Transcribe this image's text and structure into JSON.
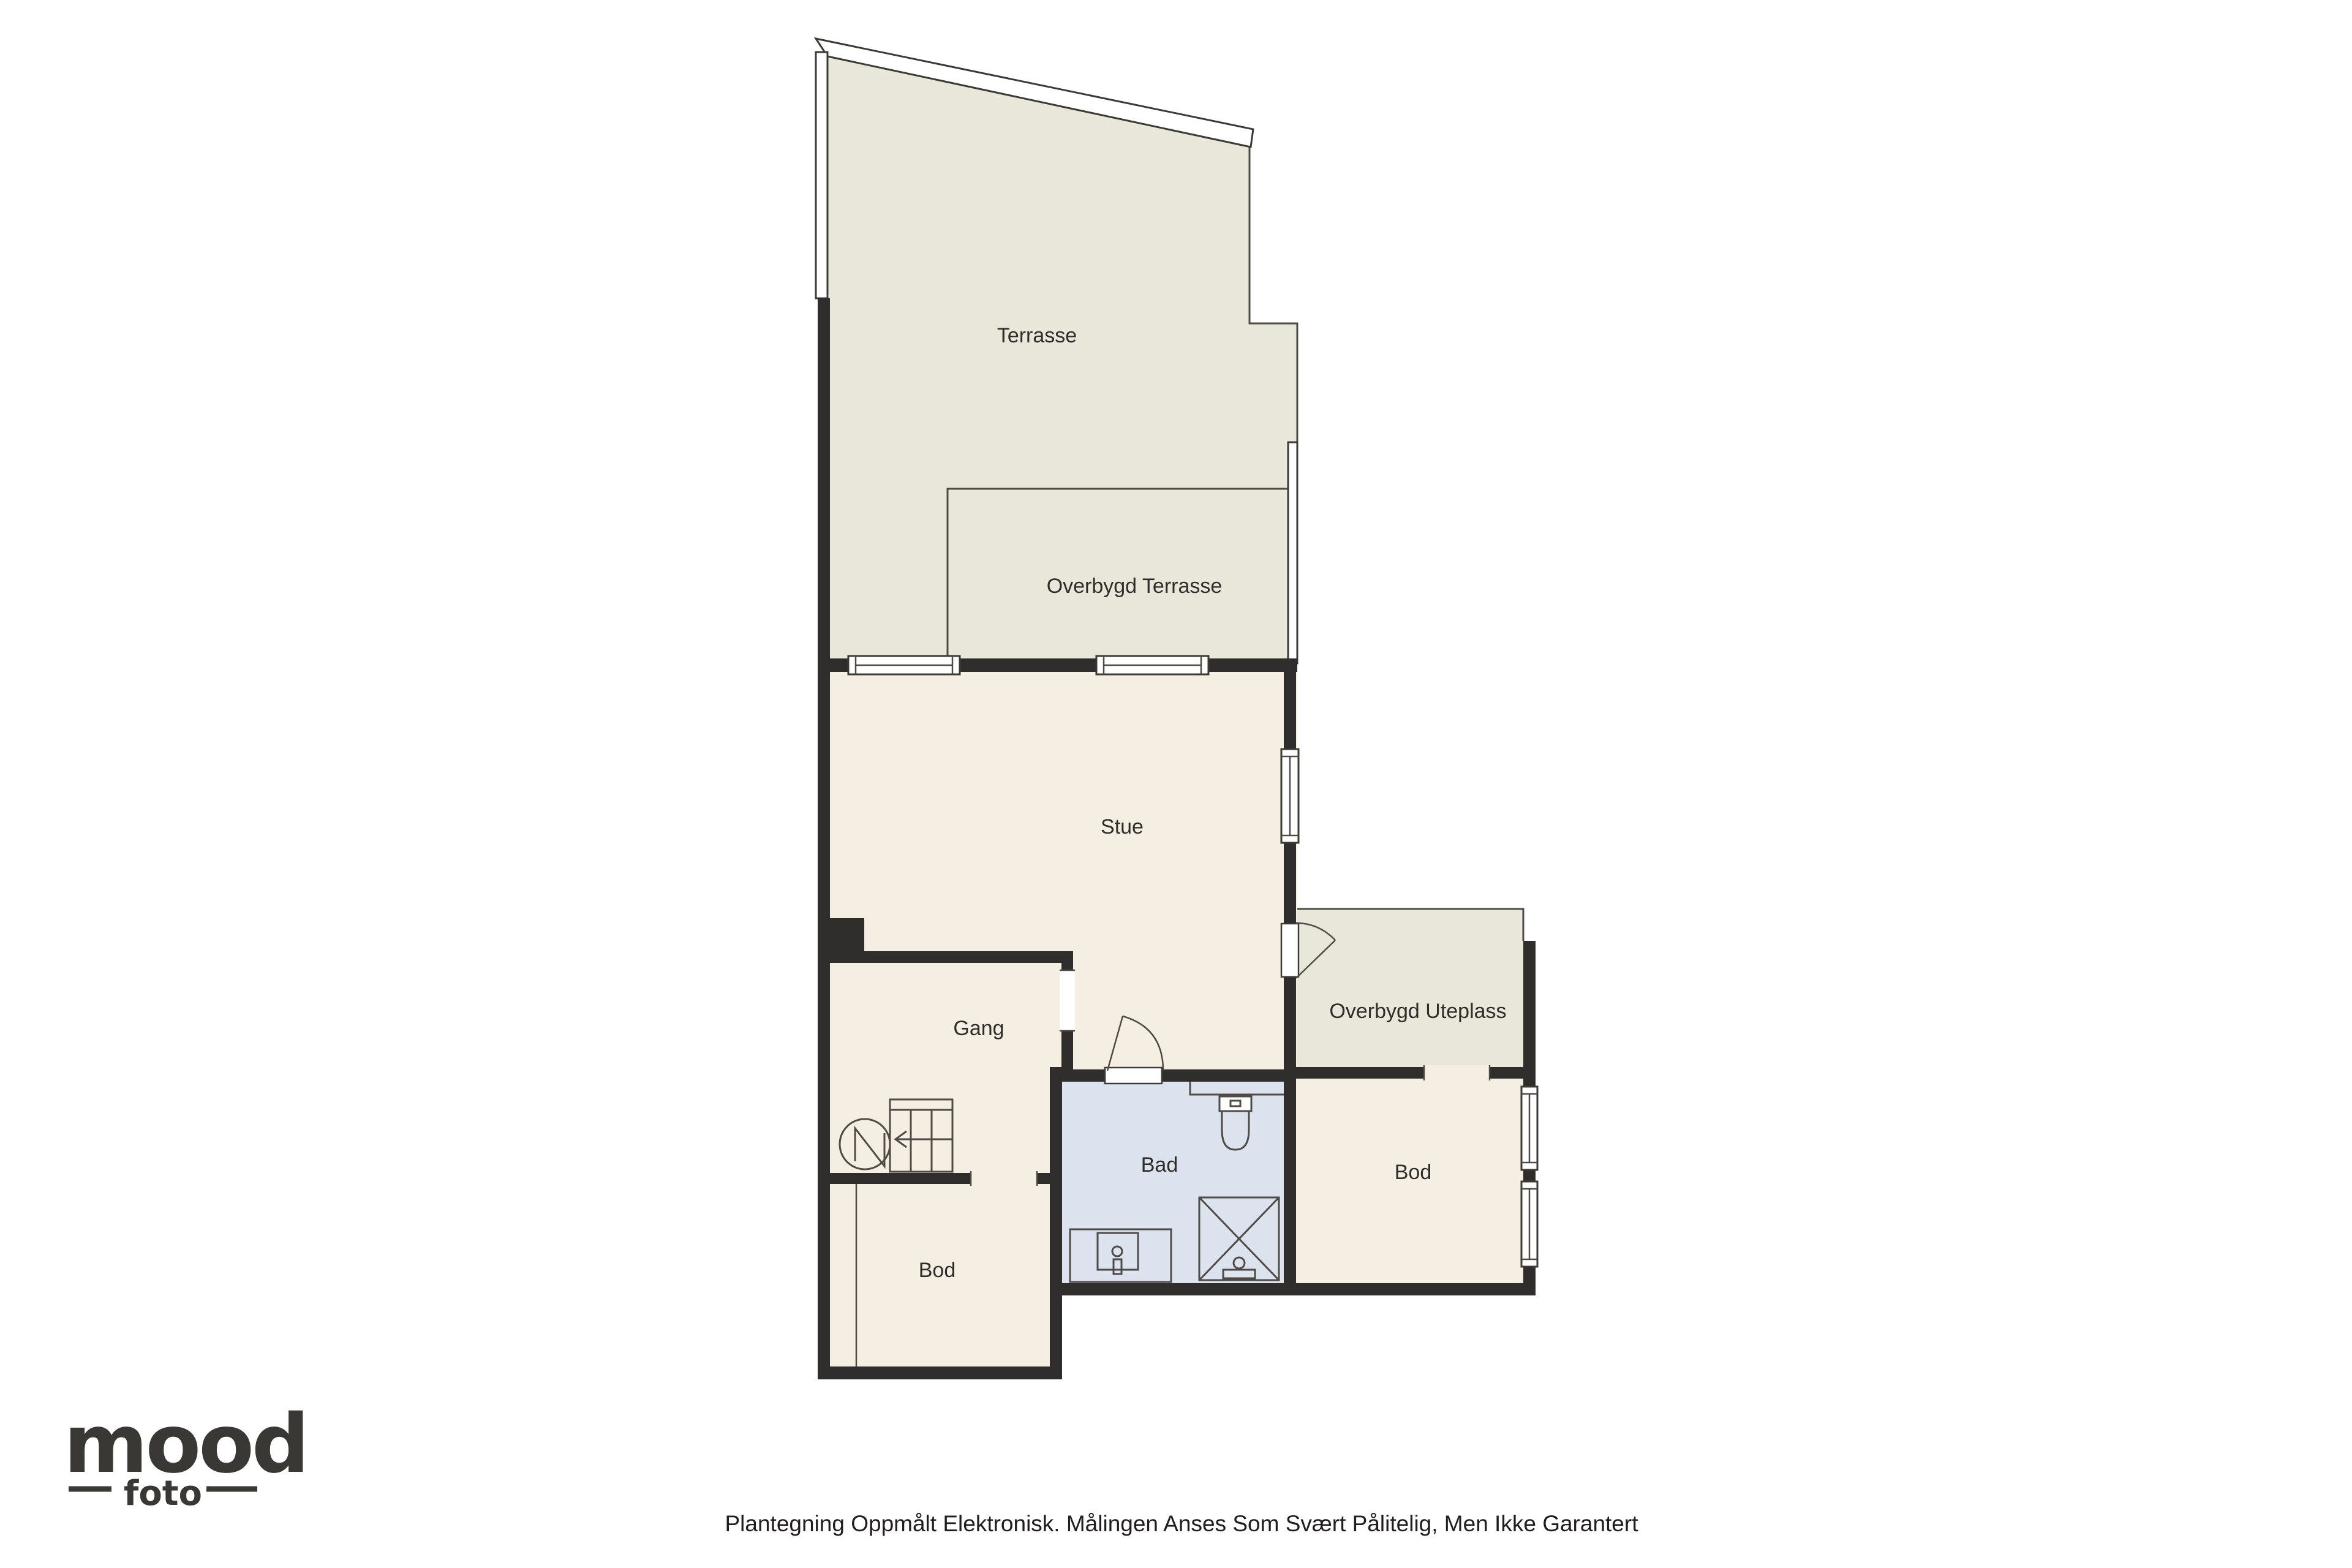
{
  "floorplan": {
    "rooms": {
      "terrasse": {
        "label": "Terrasse"
      },
      "overbygd_terrasse": {
        "label": "Overbygd Terrasse"
      },
      "stue": {
        "label": "Stue"
      },
      "gang": {
        "label": "Gang"
      },
      "overbygd_uteplass": {
        "label": "Overbygd Uteplass"
      },
      "bad": {
        "label": "Bad"
      },
      "bod_right": {
        "label": "Bod"
      },
      "bod_bottom": {
        "label": "Bod"
      }
    },
    "colors": {
      "outdoor_fill": "#e8e7da",
      "interior_fill": "#f5eee2",
      "wet_room_fill": "#dde3ee",
      "wall": "#2f2e2c",
      "thin_line": "#4e4b47"
    }
  },
  "branding": {
    "logo_primary": "mood",
    "logo_secondary": "foto"
  },
  "footer": {
    "disclaimer": "Plantegning Oppmålt Elektronisk. Målingen Anses Som Svært Pålitelig, Men Ikke Garantert"
  }
}
